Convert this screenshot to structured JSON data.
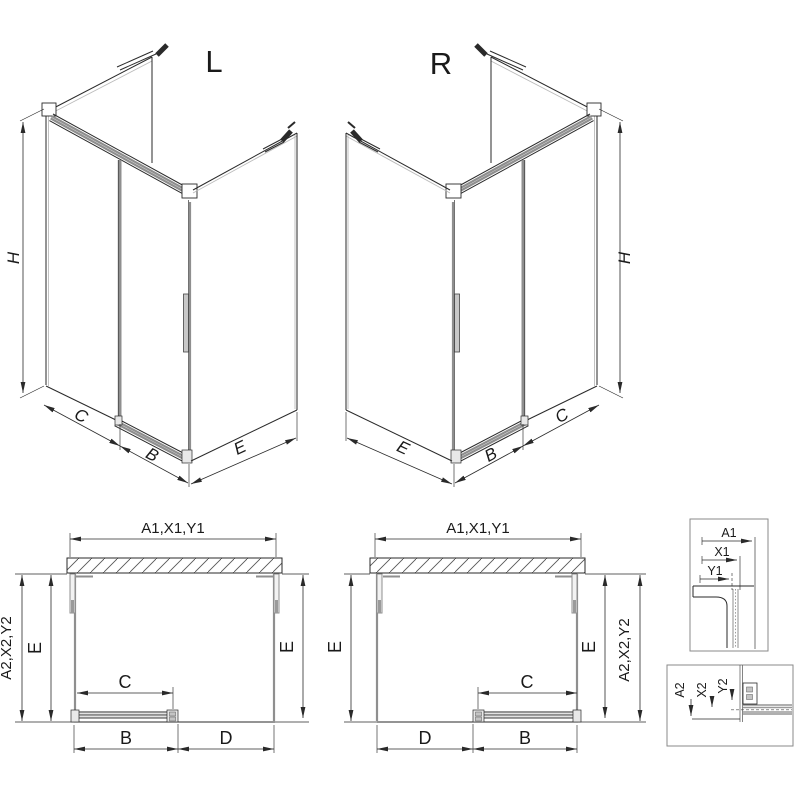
{
  "iso_left": {
    "title": "L",
    "dim_h": "H",
    "dim_c": "C",
    "dim_b": "B",
    "dim_e": "E"
  },
  "iso_right": {
    "title": "R",
    "dim_h": "H",
    "dim_c": "C",
    "dim_b": "B",
    "dim_e": "E"
  },
  "plan_left": {
    "dim_width": "A1,X1,Y1",
    "dim_outer": "A2,X2,Y2",
    "dim_e_left": "E",
    "dim_e_right": "E",
    "dim_c": "C",
    "dim_b": "B",
    "dim_d": "D"
  },
  "plan_right": {
    "dim_width": "A1,X1,Y1",
    "dim_outer": "A2,X2,Y2",
    "dim_e_left": "E",
    "dim_e_right": "E",
    "dim_c": "C",
    "dim_b": "B",
    "dim_d": "D"
  },
  "detail_width": {
    "dim_a1": "A1",
    "dim_x1": "X1",
    "dim_y1": "Y1"
  },
  "detail_rail": {
    "dim_a2": "A2",
    "dim_x2": "X2",
    "dim_y2": "Y2"
  },
  "colors": {
    "line": "#2a2a2a",
    "glass_gray": "#8f8f8f",
    "light_gray": "#bbbbbb",
    "background": "#ffffff"
  }
}
